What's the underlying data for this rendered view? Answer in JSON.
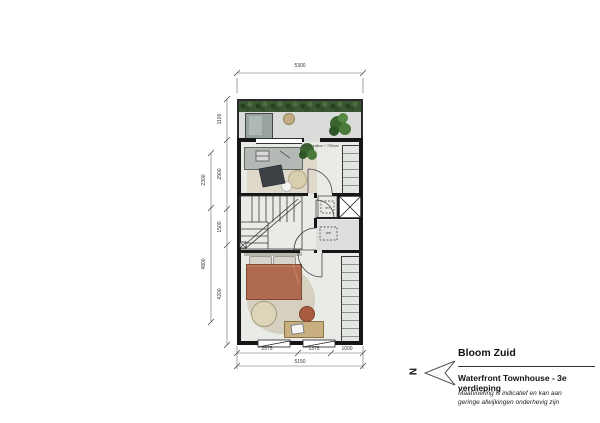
{
  "title_block": {
    "project_name": "Bloom Zuid",
    "drawing_title": "Waterfront Townhouse - 3e verdieping",
    "disclaimer_line1": "Maatvoering is indicatief en kan aan",
    "disclaimer_line2": "geringe afwijkingen onderhevig zijn",
    "north_label": "N"
  },
  "dimensions": {
    "top_total": "5300",
    "left_inner": [
      "1100",
      "2900",
      "1500",
      "4200"
    ],
    "left_outer": [
      "2300",
      "4800"
    ],
    "bottom_segments": [
      "2575",
      "1375",
      "1000"
    ],
    "bottom_total": "5150"
  },
  "plan_labels": {
    "vent_closet": "mv",
    "washer": "wm",
    "terrace_note": "opstap balkon + 750mm"
  },
  "colors": {
    "wall": "#161616",
    "interior_floor": "#e9ebe7",
    "terrace_floor": "#dadcd9",
    "hedge_green": "#3c5631",
    "bed_terracotta": "#b06a50",
    "wood": "#c9ae80",
    "plant_green": "#4a7a3a"
  }
}
